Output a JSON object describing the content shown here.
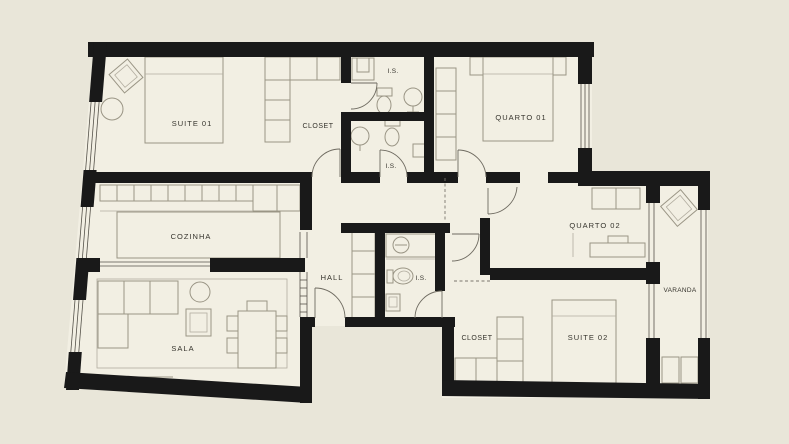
{
  "meta": {
    "drawing_type": "apartment floor plan",
    "background_color": "#e9e6d9",
    "floor_color": "#f2efe3",
    "wall_color": "#191919",
    "furniture_line_color": "#9a9585",
    "label_color": "#35332c"
  },
  "rooms": [
    {
      "id": "suite-01",
      "label": "SUITE 01"
    },
    {
      "id": "closet-top",
      "label": "CLOSET"
    },
    {
      "id": "is-top",
      "label": "I.S."
    },
    {
      "id": "quarto-01",
      "label": "QUARTO 01"
    },
    {
      "id": "is-mid",
      "label": "I.S."
    },
    {
      "id": "cozinha",
      "label": "COZINHA"
    },
    {
      "id": "hall",
      "label": "HALL"
    },
    {
      "id": "is-hall",
      "label": "I.S."
    },
    {
      "id": "quarto-02",
      "label": "QUARTO 02"
    },
    {
      "id": "varanda",
      "label": "VARANDA"
    },
    {
      "id": "sala",
      "label": "SALA"
    },
    {
      "id": "closet-bottom",
      "label": "CLOSET"
    },
    {
      "id": "suite-02",
      "label": "SUITE 02"
    }
  ]
}
